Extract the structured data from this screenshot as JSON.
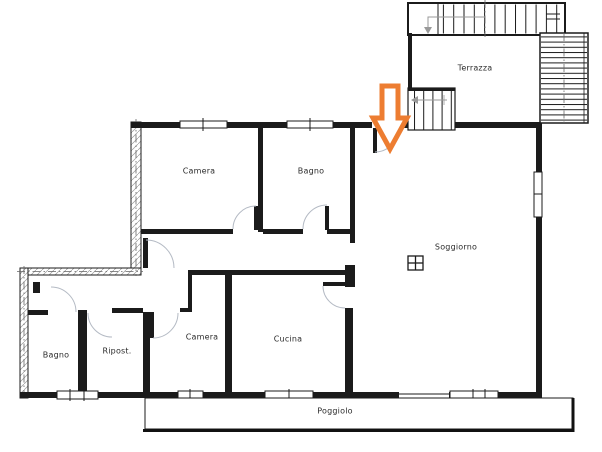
{
  "plan": {
    "type": "apartment-floor-plan",
    "colors": {
      "wall": "#1b1b1b",
      "door_arc": "#b4bac4",
      "hatch": "#9a9a9a",
      "arrow": "#ED7D31",
      "arrow_fill": "#ffffff",
      "text": "#2b2b2b",
      "background": "#ffffff"
    },
    "rooms": [
      {
        "id": "terrazza",
        "label": "Terrazza"
      },
      {
        "id": "camera-top",
        "label": "Camera"
      },
      {
        "id": "bagno-top",
        "label": "Bagno"
      },
      {
        "id": "soggiorno",
        "label": "Soggiorno"
      },
      {
        "id": "camera-bottom",
        "label": "Camera"
      },
      {
        "id": "cucina",
        "label": "Cucina"
      },
      {
        "id": "ripost",
        "label": "Ripost."
      },
      {
        "id": "bagno-bottom",
        "label": "Bagno"
      },
      {
        "id": "poggiolo",
        "label": "Poggiolo"
      }
    ],
    "icons": {
      "entrance_arrow": "orange-block-arrow-down",
      "stair_direction_top": "arrow-left-then-down",
      "stair_direction_terrace": "arrow-left",
      "shaft_symbol": "crossed-square"
    }
  }
}
